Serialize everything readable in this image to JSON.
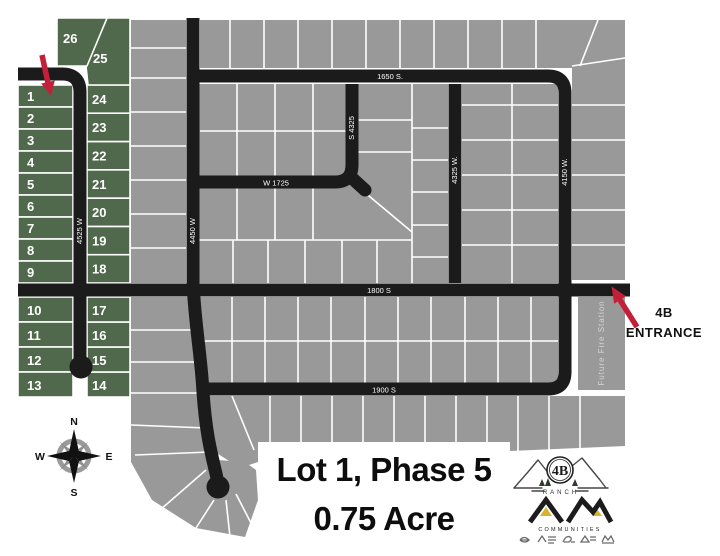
{
  "map": {
    "annotations": {
      "lot_title_line1": "Lot 1, Phase 5",
      "lot_title_line2": "0.75 Acre",
      "entrance_line1": "4B",
      "entrance_line2": "ENTRANCE",
      "future_fire_station": "Future Fire Station"
    },
    "streets": {
      "s1650": "1650 S.",
      "w1725": "W 1725",
      "s1800": "1800 S",
      "s1900": "1900 S",
      "w4525": "4525 W",
      "w4450": "4450 W",
      "s4325": "S 4325",
      "w4325": "4325 W.",
      "w4150": "4150 W."
    },
    "lots": {
      "phase_lot_numbers": [
        "1",
        "2",
        "3",
        "4",
        "5",
        "6",
        "7",
        "8",
        "9",
        "10",
        "11",
        "12",
        "13",
        "14",
        "15",
        "16",
        "17",
        "18",
        "19",
        "20",
        "21",
        "22",
        "23",
        "24",
        "25",
        "26"
      ]
    },
    "compass": {
      "north": "N",
      "south": "S",
      "east": "E",
      "west": "W"
    },
    "colors": {
      "lot_green": "#50684b",
      "lot_gray": "#999999",
      "road_black": "#1b1b1b",
      "arrow_red": "#c41f39",
      "background": "#ffffff"
    },
    "logos": {
      "ranch_badge_text": "4B",
      "ranch_name": "RANCH",
      "builder_initials": "AM",
      "builder_name": "COMMUNITIES"
    }
  }
}
